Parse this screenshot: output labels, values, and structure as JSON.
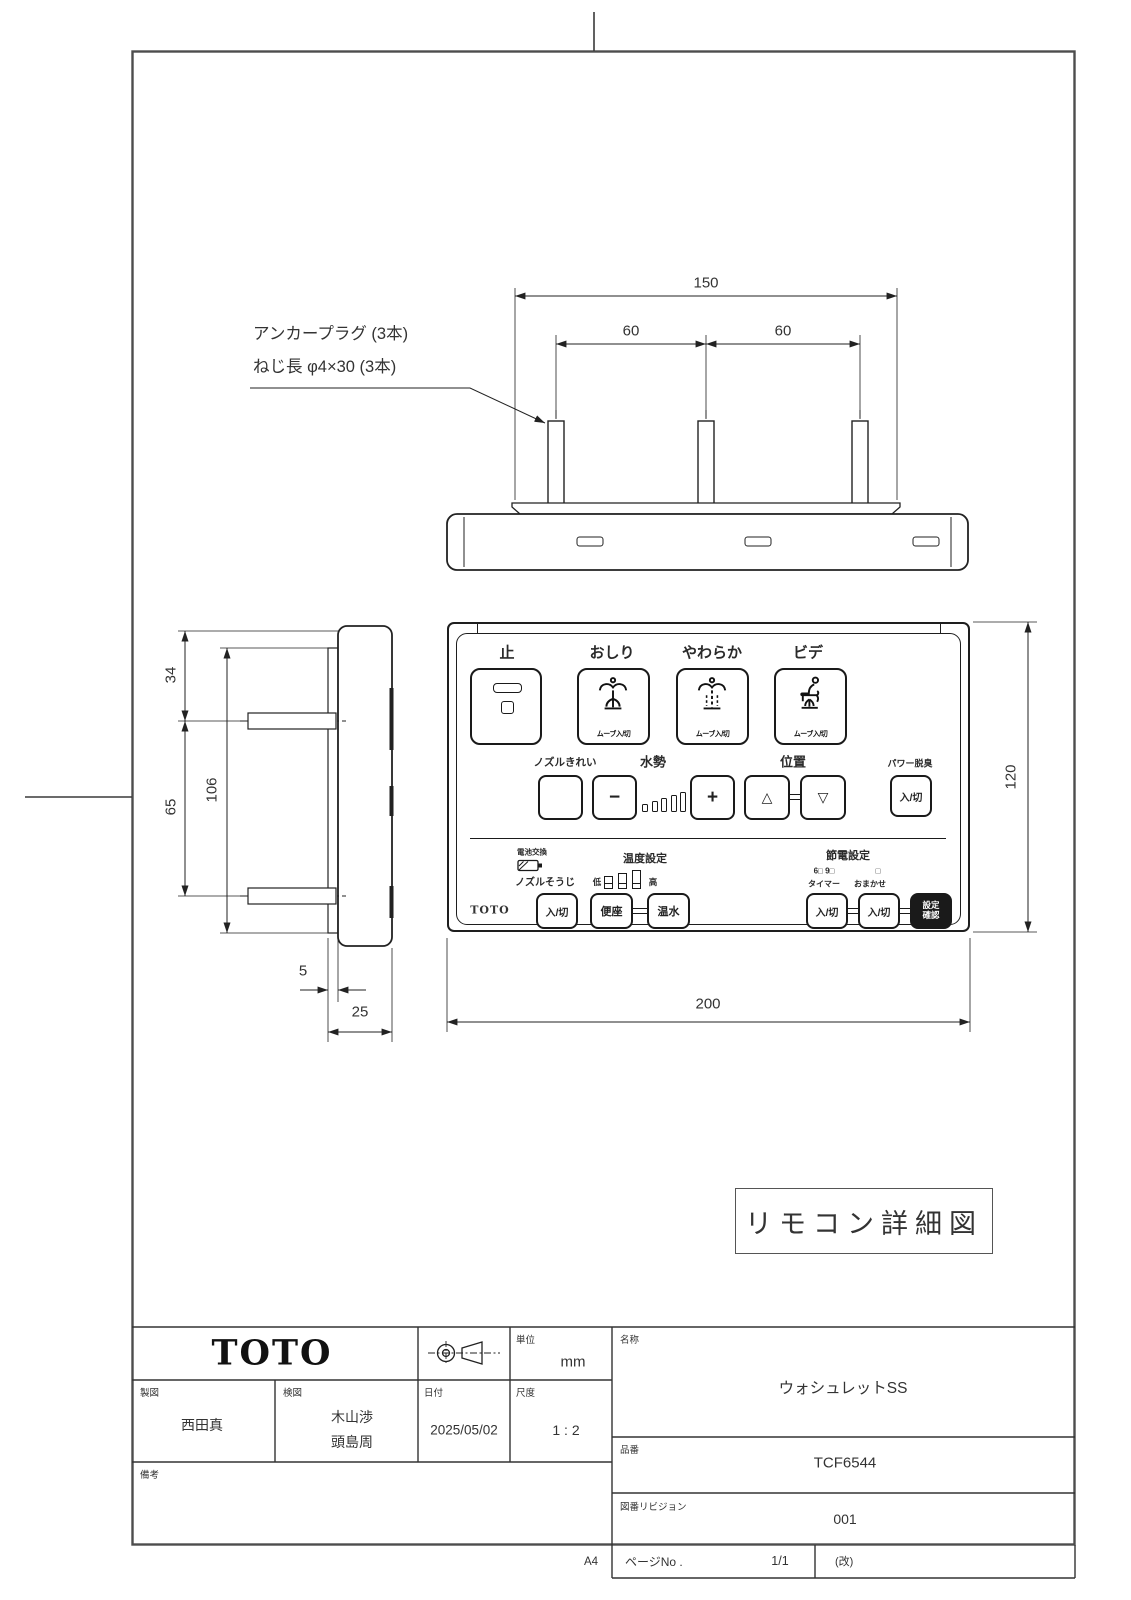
{
  "callout": {
    "line1": "アンカープラグ (3本)",
    "line2": "ねじ長 φ4×30 (3本)"
  },
  "dims": {
    "top_width": "150",
    "pitch_left": "60",
    "pitch_right": "60",
    "side_top": "34",
    "side_mid": "65",
    "side_total": "106",
    "plate_thickness": "5",
    "depth": "25",
    "front_width": "200",
    "front_height": "120"
  },
  "caption": "リモコン詳細図",
  "remote": {
    "stop": "止",
    "oshiri": "おしり",
    "yawaraka": "やわらか",
    "bide": "ビデ",
    "move_onoff": "ムーブ入/切",
    "nozzle_clean": "ノズルきれい",
    "water_pressure": "水勢",
    "minus": "−",
    "plus": "+",
    "position": "位置",
    "up": "△",
    "down": "▽",
    "power_deodorizer": "パワー脱臭",
    "onoff": "入/切",
    "battery": "電池交換",
    "temp_setting": "温度設定",
    "eco_setting": "節電設定",
    "eco_leds": "6□ 9□",
    "eco_led_right": "□",
    "nozzle_souji": "ノズルそうじ",
    "low": "低",
    "high": "高",
    "timer": "タイマー",
    "omakase": "おまかせ",
    "seat": "便座",
    "warm_water": "温水",
    "set_line1": "設定",
    "set_line2": "確認",
    "brand": "TOTO"
  },
  "title_block": {
    "brand": "TOTO",
    "unit_label": "単位",
    "unit": "mm",
    "drafter_label": "製図",
    "drafter": "西田真",
    "checker_label": "検図",
    "checker_1": "木山渉",
    "checker_2": "頭島周",
    "date_label": "日付",
    "date": "2025/05/02",
    "scale_label": "尺度",
    "scale": "1 : 2",
    "remarks_label": "備考",
    "name_label": "名称",
    "name": "ウォシュレットSS",
    "part_no_label": "品番",
    "part_no": "TCF6544",
    "revision_label": "図番リビジョン",
    "revision": "001",
    "page_label": "ページNo .",
    "page": "1/1",
    "rev_note": "(改)",
    "paper_size": "A4"
  }
}
